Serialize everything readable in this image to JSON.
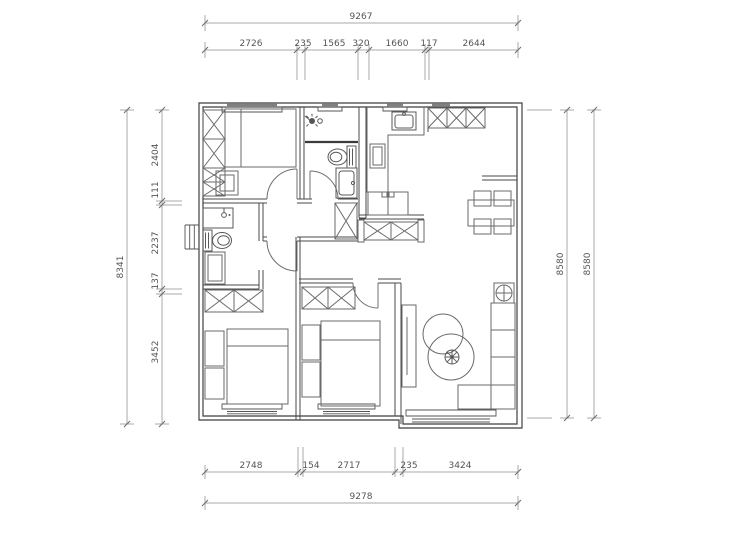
{
  "drawing": {
    "kind": "apartment-floor-plan"
  },
  "colors": {
    "background": "#ffffff",
    "wall": "#3f3f3f",
    "furniture": "#6a6a6a",
    "dimension_line": "#a9a9a9",
    "dimension_text": "#555555"
  },
  "dimensions": {
    "top": {
      "overall": "9267",
      "segments": [
        "2726",
        "235",
        "1565",
        "320",
        "1660",
        "117",
        "2644"
      ]
    },
    "bottom": {
      "overall": "9278",
      "segments": [
        "2748",
        "154",
        "2717",
        "235",
        "3424"
      ]
    },
    "left": {
      "overall": "8341",
      "segments": [
        "2404",
        "111",
        "2237",
        "137",
        "3452"
      ]
    },
    "right": {
      "segments": [
        "8580",
        "8580"
      ]
    }
  },
  "icons": [
    "wardrobe-x-box",
    "toilet",
    "washbasin",
    "shower-head",
    "kitchen-sink",
    "cooktop",
    "washing-machine",
    "dining-table",
    "chair",
    "sofa",
    "coffee-table",
    "potted-plant",
    "tv-cabinet",
    "door-swing",
    "window-hatch"
  ]
}
